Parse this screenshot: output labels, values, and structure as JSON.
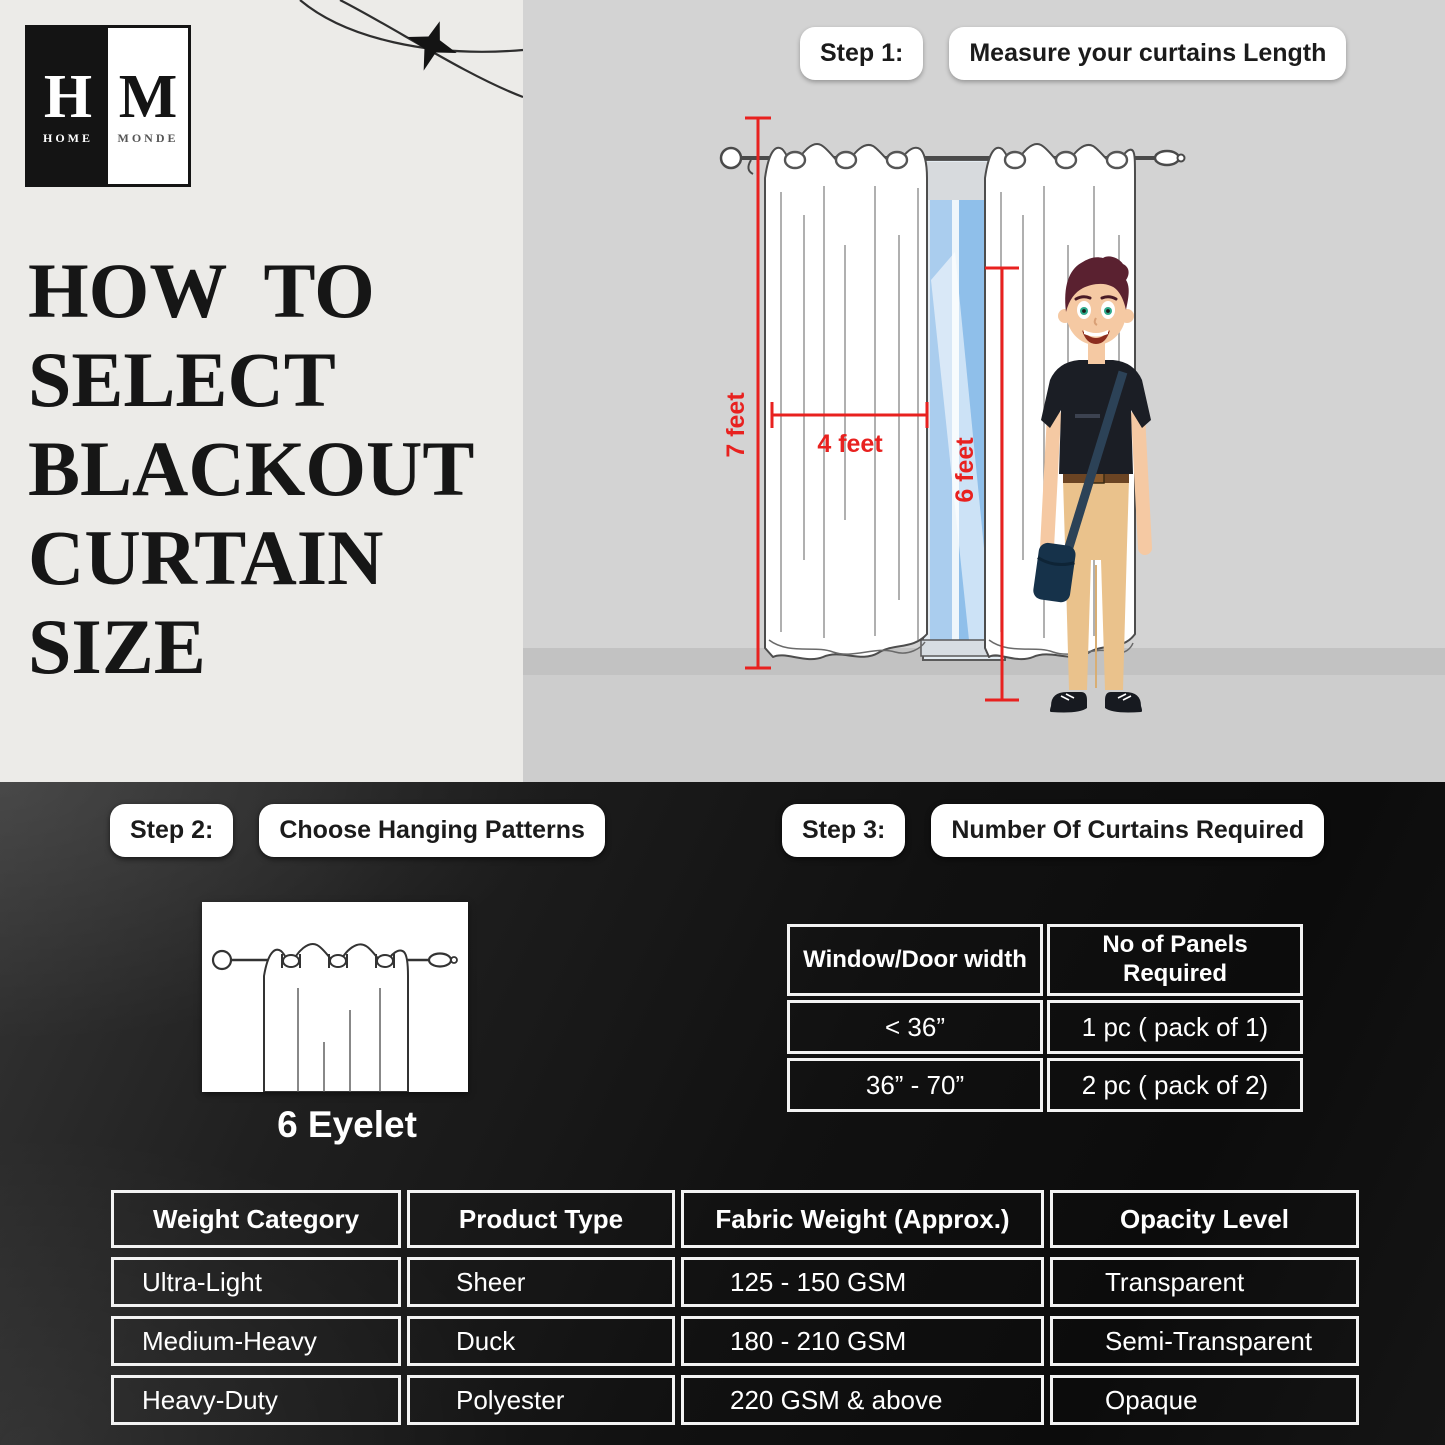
{
  "logo": {
    "h": "H",
    "home": "HOME",
    "m": "M",
    "monde": "MONDE"
  },
  "title": {
    "line1": "HOW  TO",
    "line2": "SELECT",
    "line3": "BLACKOUT",
    "line4": "CURTAIN",
    "line5": "SIZE"
  },
  "steps": {
    "step1": {
      "label": "Step 1:",
      "text": "Measure your curtains Length"
    },
    "step2": {
      "label": "Step 2:",
      "text": "Choose Hanging Patterns"
    },
    "step3": {
      "label": "Step 3:",
      "text": "Number Of Curtains Required"
    }
  },
  "scene": {
    "labels": {
      "height": "7 feet",
      "width": "4 feet",
      "door": "6 feet"
    }
  },
  "hanging": {
    "caption": "6 Eyelet"
  },
  "panels_table": {
    "headers": [
      "Window/Door width",
      "No of Panels Required"
    ],
    "rows": [
      [
        "<  36”",
        "1 pc ( pack of 1)"
      ],
      [
        "36” - 70”",
        "2 pc ( pack of 2)"
      ]
    ]
  },
  "fabric_table": {
    "headers": [
      "Weight Category",
      "Product Type",
      "Fabric Weight (Approx.)",
      "Opacity Level"
    ],
    "rows": [
      [
        "Ultra-Light",
        "Sheer",
        "125 - 150 GSM",
        "Transparent"
      ],
      [
        "Medium-Heavy",
        "Duck",
        "180 - 210 GSM",
        "Semi-Transparent"
      ],
      [
        "Heavy-Duty",
        "Polyester",
        "220  GSM & above",
        "Opaque"
      ]
    ]
  },
  "icons": {
    "decor": "airplane-swoosh"
  },
  "colors": {
    "accent_red": "#e8211f",
    "panel_light": "#ecebe8",
    "panel_gray": "#d3d3d3",
    "dark_bg": "#141414",
    "pill_bg": "#ffffff",
    "text_dark": "#141414",
    "text_light": "#ffffff",
    "window_blue": "#9cc6ee",
    "skin": "#f5c9a3",
    "hair": "#5a2130",
    "pants": "#eac28c"
  }
}
